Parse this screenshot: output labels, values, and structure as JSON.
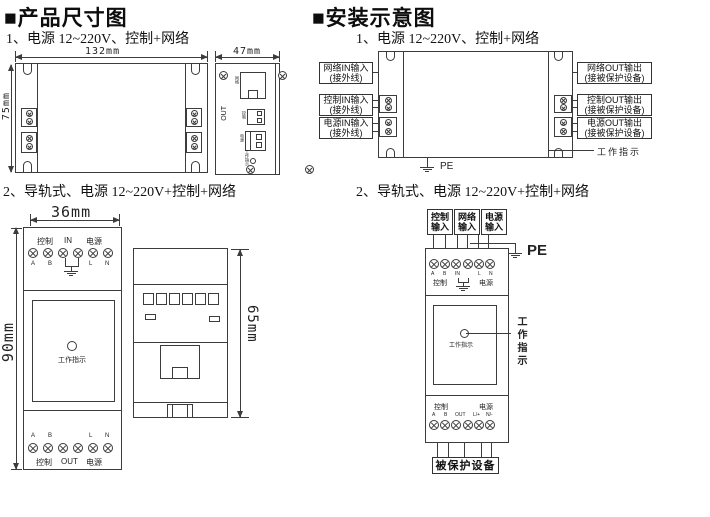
{
  "left": {
    "title": "■产品尺寸图",
    "item1": "1、电源 12~220V、控制+网络",
    "item2": "2、导轨式、电源 12~220V+控制+网络",
    "front": {
      "dim_w": "132mm",
      "dim_h": "75mm"
    },
    "side": {
      "dim_w": "47mm",
      "out": "OUT",
      "net": "网络",
      "ctrl": "控制",
      "pwr": "电源",
      "ind": "工作指示"
    },
    "rail_front": {
      "dim_w": "36mm",
      "dim_h": "90mm",
      "top": {
        "ctrl": "控制",
        "mid": "IN",
        "pwr": "电源",
        "a": "A",
        "b": "B",
        "l": "L",
        "n": "N"
      },
      "indicator": "工作指示",
      "bottom": {
        "a": "A",
        "b": "B",
        "l": "L",
        "n": "N",
        "ctrl": "控制",
        "mid": "OUT",
        "pwr": "电源"
      }
    },
    "rail_side": {
      "dim_h": "65mm"
    }
  },
  "right": {
    "title": "■安装示意图",
    "item1": "1、电源 12~220V、控制+网络",
    "item2": "2、导轨式、电源 12~220V+控制+网络",
    "diag1": {
      "inputs": [
        {
          "l1": "网络IN输入",
          "l2": "(接外线)"
        },
        {
          "l1": "控制IN输入",
          "l2": "(接外线)"
        },
        {
          "l1": "电源IN输入",
          "l2": "(接外线)"
        }
      ],
      "outputs": [
        {
          "l1": "网络OUT输出",
          "l2": "(接被保护设备)"
        },
        {
          "l1": "控制OUT输出",
          "l2": "(接被保护设备)"
        },
        {
          "l1": "电源OUT输出",
          "l2": "(接被保护设备)"
        }
      ],
      "indicator": "工作指示",
      "pe": "PE"
    },
    "diag2": {
      "top_boxes": [
        {
          "l1": "控制",
          "l2": "输入"
        },
        {
          "l1": "网络",
          "l2": "输入"
        },
        {
          "l1": "电源",
          "l2": "输入"
        }
      ],
      "pe": "PE",
      "top": {
        "a": "A",
        "b": "B",
        "mid": "IN",
        "l": "L",
        "n": "N",
        "ctrl": "控制",
        "pwr": "电源"
      },
      "indicator": "工作指示",
      "callout": "工作指示",
      "bottom": {
        "ctrl": "控制",
        "pwr": "电源",
        "a": "A",
        "b": "B",
        "mid": "OUT",
        "l": "L/+",
        "n": "N/-"
      },
      "protected": "被保护设备"
    }
  }
}
